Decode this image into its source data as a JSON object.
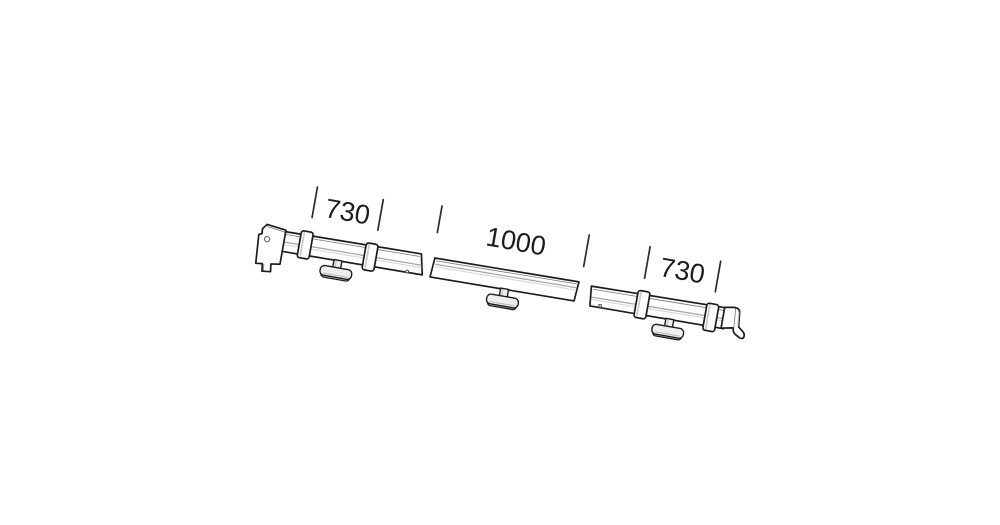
{
  "diagram": {
    "title": "Rail assembly parts diagram",
    "segments": [
      {
        "id": "left",
        "dimension_label": "730",
        "parts": [
          "end-bracket",
          "clamp-collar",
          "clamp-collar",
          "t-knob",
          "rail-bar"
        ]
      },
      {
        "id": "middle",
        "dimension_label": "1000",
        "parts": [
          "rail-bar",
          "t-knob"
        ]
      },
      {
        "id": "right",
        "dimension_label": "730",
        "parts": [
          "rail-bar",
          "clamp-collar",
          "clamp-collar",
          "t-knob",
          "end-cap"
        ]
      }
    ],
    "colors": {
      "background": "#ffffff",
      "outline": "#1d1d1b",
      "groove_shading": "#a6a6a6",
      "knob_fill": "#efefef",
      "dimension_text": "#1d1d1b"
    }
  }
}
